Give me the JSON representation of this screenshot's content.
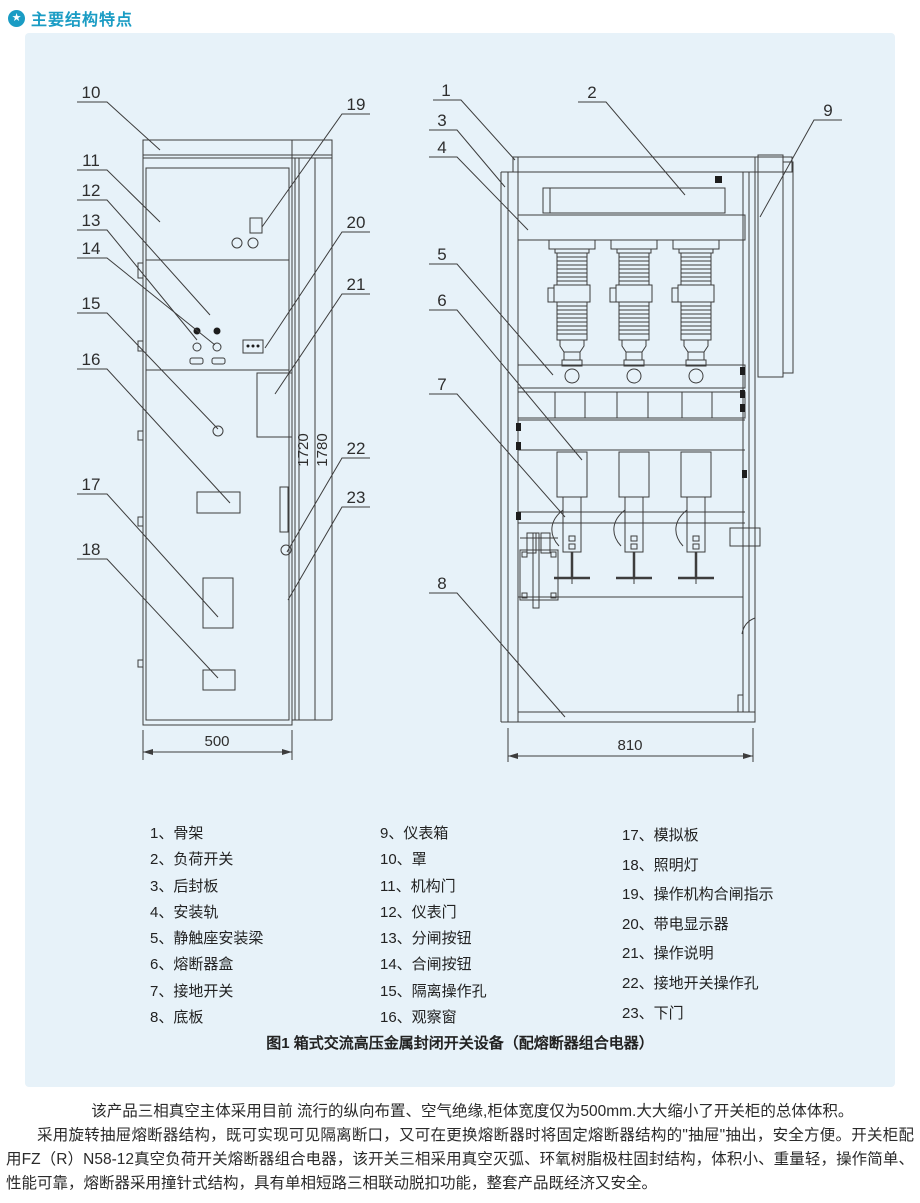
{
  "header": {
    "title": "主要结构特点",
    "icon": "star-circle-icon",
    "accent_color": "#1a9cc4"
  },
  "figure": {
    "caption": "图1 箱式交流高压金属封闭开关设备（配熔断器组合电器）",
    "dimensions": {
      "front_width": "500",
      "side_width": "810",
      "inner_height": "1720",
      "total_height": "1780"
    },
    "front_view": {
      "callouts": [
        "10",
        "11",
        "12",
        "13",
        "14",
        "15",
        "16",
        "17",
        "18",
        "19",
        "20",
        "21",
        "22",
        "23"
      ]
    },
    "side_view": {
      "callouts": [
        "1",
        "2",
        "3",
        "4",
        "5",
        "6",
        "7",
        "8",
        "9"
      ]
    }
  },
  "legend": {
    "col1": [
      "1、骨架",
      "2、负荷开关",
      "3、后封板",
      "4、安装轨",
      "5、静触座安装梁",
      "6、熔断器盒",
      "7、接地开关",
      "8、底板"
    ],
    "col2": [
      "9、仪表箱",
      "10、罩",
      "11、机构门",
      "12、仪表门",
      "13、分闸按钮",
      "14、合闸按钮",
      "15、隔离操作孔",
      "16、观察窗"
    ],
    "col3": [
      "17、模拟板",
      "18、照明灯",
      "19、操作机构合闸指示",
      "20、带电显示器",
      "21、操作说明",
      "22、接地开关操作孔",
      "23、下门"
    ]
  },
  "body_text": {
    "p1": "该产品三相真空主体采用目前 流行的纵向布置、空气绝缘,柜体宽度仅为500mm.大大缩小了开关柜的总体体积。",
    "p2": "采用旋转抽屉熔断器结构，既可实现可见隔离断口，又可在更换熔断器时将固定熔断器结构的\"抽屉\"抽出，安全方便。开关柜配用FZ（R）N58-12真空负荷开关熔断器组合电器，该开关三相采用真空灭弧、环氧树脂极柱固封结构，体积小、重量轻，操作简单、性能可靠，熔断器采用撞针式结构，具有单相短路三相联动脱扣功能，整套产品既经济又安全。"
  },
  "colors": {
    "accent": "#1a9cc4",
    "panel_bg": "#e7f2f9",
    "line": "#3d3d3d",
    "text": "#2a2a2a"
  }
}
